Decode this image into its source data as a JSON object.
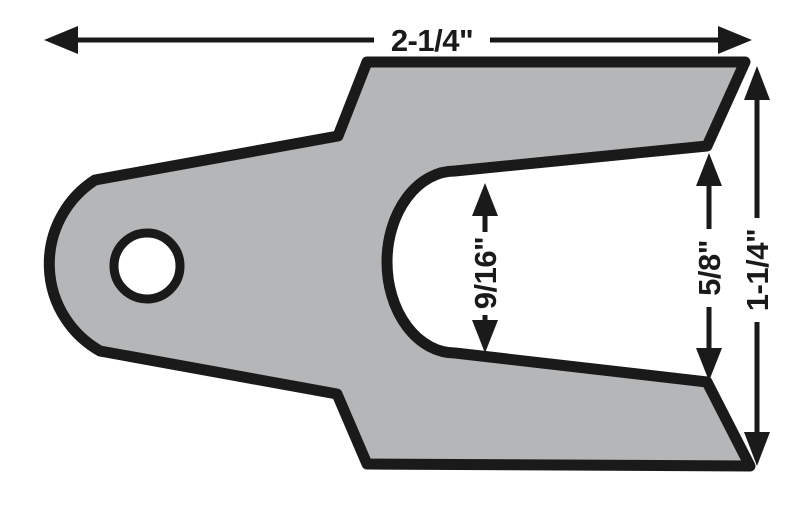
{
  "diagram": {
    "dimensions": {
      "overall_width": "2-1/4\"",
      "overall_height": "1-1/4\"",
      "slot_width": "9/16\"",
      "fork_opening": "5/8\""
    },
    "colors": {
      "part_fill": "#b5b6b8",
      "line": "#1a1a1a",
      "hole_fill": "#ffffff",
      "background": "#ffffff"
    }
  }
}
